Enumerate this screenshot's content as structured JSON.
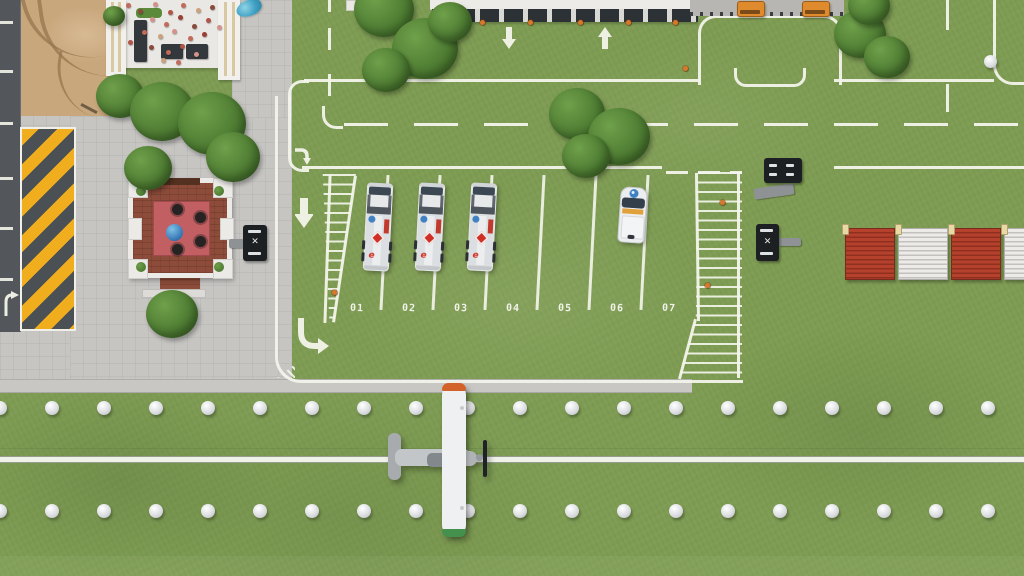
{
  "meta": {
    "scene": "airport-apron-overhead-view",
    "style": "top-down management sim"
  },
  "palette": {
    "grass": "#7e9c53",
    "asphalt": "#53575b",
    "sand": "#c9a77d",
    "pavement": "#c6c5c2",
    "line_white": "#f3f4ea",
    "chevron_yellow": "#f0ae1e",
    "chevron_gray": "#4b5054",
    "fence_red": "#b5412d",
    "fence_white": "#ecebe8",
    "truck_white": "#e6e8ea",
    "hazard_red": "#cf2f24",
    "brand_blue": "#3f81c2",
    "cone_orange": "#d9782d",
    "brick": "#8d4c3a",
    "mat_red": "#c25f63",
    "equipment_black": "#1d2023",
    "cart_orange": "#e08a2e",
    "crowd_colors": [
      "#c26a5c",
      "#8a4a3c",
      "#d4938a",
      "#b05548",
      "#caa27e",
      "#9b3f35"
    ]
  },
  "parking": {
    "spots": [
      {
        "label": "01",
        "occupied_by": "fuel-truck"
      },
      {
        "label": "02",
        "occupied_by": "fuel-truck"
      },
      {
        "label": "03",
        "occupied_by": "fuel-truck"
      },
      {
        "label": "04",
        "occupied_by": ""
      },
      {
        "label": "05",
        "occupied_by": ""
      },
      {
        "label": "06",
        "occupied_by": "service-van"
      },
      {
        "label": "07",
        "occupied_by": ""
      }
    ]
  },
  "icons": {
    "equipment_marking": "✕"
  },
  "branding": {
    "truck_logo_letter": "e"
  },
  "layout": {
    "spot_labels": {
      "start_x": 346,
      "spacing": 52,
      "top": 303
    },
    "dividers": {
      "start_x": 383,
      "spacing": 52,
      "count": 6,
      "top": 175
    },
    "runway_lights": {
      "rows_y": [
        401,
        504
      ],
      "start_x": -7,
      "spacing": 52,
      "count": 20
    },
    "taxiway_dome": {
      "x": 984,
      "y": 55
    },
    "road_dashes_left": {
      "ys": [
        21,
        70,
        122,
        177,
        227,
        278
      ]
    },
    "fence": {
      "x": 845,
      "y": 228,
      "panel_width": 48,
      "pitch": 53,
      "height": 50,
      "panels": [
        "red",
        "white",
        "red",
        "white"
      ]
    },
    "fuel_trucks": [
      [
        365,
        183
      ],
      [
        417,
        183
      ],
      [
        469,
        183
      ]
    ],
    "depot_carts": [
      [
        737,
        1
      ],
      [
        802,
        1
      ]
    ],
    "trees": [
      [
        96,
        74,
        48
      ],
      [
        130,
        82,
        64
      ],
      [
        178,
        92,
        68
      ],
      [
        206,
        132,
        54
      ],
      [
        124,
        146,
        48
      ],
      [
        146,
        290,
        52
      ],
      [
        354,
        -18,
        60
      ],
      [
        392,
        18,
        66
      ],
      [
        362,
        48,
        48
      ],
      [
        428,
        2,
        44
      ],
      [
        549,
        88,
        56
      ],
      [
        588,
        108,
        62
      ],
      [
        562,
        134,
        48
      ],
      [
        834,
        10,
        52
      ],
      [
        864,
        36,
        46
      ],
      [
        848,
        -14,
        42
      ],
      [
        103,
        6,
        22
      ]
    ],
    "crowd": [
      [
        126,
        3,
        0
      ],
      [
        138,
        9,
        1
      ],
      [
        153,
        2,
        2
      ],
      [
        168,
        10,
        3
      ],
      [
        181,
        3,
        0
      ],
      [
        196,
        8,
        4
      ],
      [
        210,
        5,
        1
      ],
      [
        150,
        17,
        2
      ],
      [
        164,
        22,
        0
      ],
      [
        178,
        15,
        5
      ],
      [
        192,
        24,
        1
      ],
      [
        206,
        18,
        3
      ],
      [
        142,
        30,
        0
      ],
      [
        158,
        34,
        4
      ],
      [
        172,
        29,
        2
      ],
      [
        188,
        36,
        0
      ],
      [
        202,
        32,
        5
      ],
      [
        149,
        45,
        1
      ],
      [
        166,
        50,
        0
      ],
      [
        180,
        44,
        3
      ],
      [
        194,
        52,
        2
      ],
      [
        161,
        58,
        4
      ],
      [
        176,
        60,
        0
      ],
      [
        128,
        40,
        3
      ],
      [
        217,
        25,
        2
      ]
    ],
    "cones": [
      [
        433,
        20
      ],
      [
        480,
        20
      ],
      [
        528,
        20
      ],
      [
        578,
        20
      ],
      [
        626,
        20
      ],
      [
        673,
        20
      ],
      [
        683,
        66
      ],
      [
        435,
        69
      ],
      [
        332,
        290
      ],
      [
        720,
        200
      ],
      [
        705,
        283
      ]
    ]
  }
}
